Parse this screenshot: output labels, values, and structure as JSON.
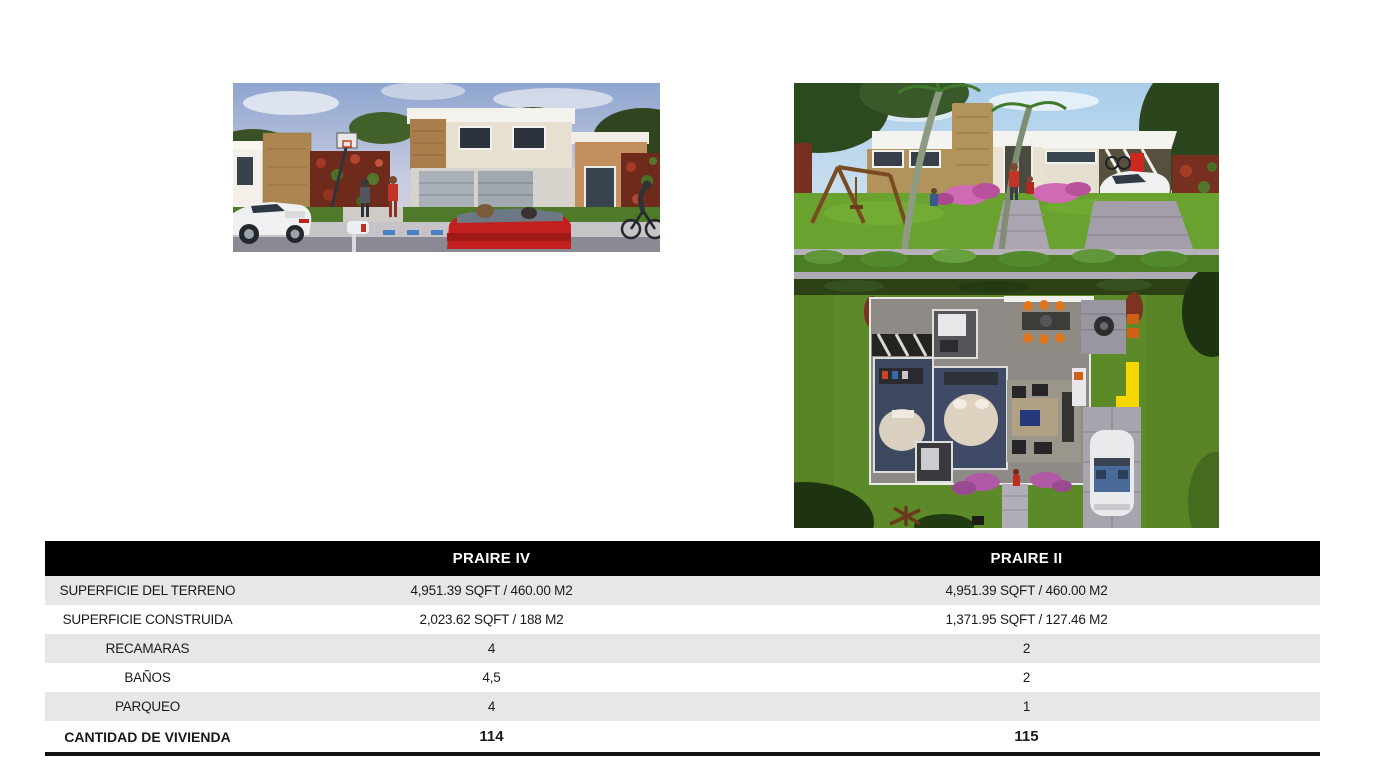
{
  "images": {
    "left_label": "PRAIRE IV street view render",
    "right_top_label": "PRAIRE II street view render",
    "right_bottom_label": "PRAIRE II aerial floor-plan render"
  },
  "table": {
    "header": {
      "col1": "PRAIRE IV",
      "col2": "PRAIRE II"
    },
    "rows": [
      {
        "label": "SUPERFICIE DEL TERRENO",
        "col1": "4,951.39 SQFT / 460.00 M2",
        "col2": "4,951.39 SQFT / 460.00 M2"
      },
      {
        "label": "SUPERFICIE CONSTRUIDA",
        "col1": "2,023.62 SQFT / 188 M2",
        "col2": "1,371.95 SQFT / 127.46 M2"
      },
      {
        "label": "RECAMARAS",
        "col1": "4",
        "col2": "2"
      },
      {
        "label": "BAÑOS",
        "col1": "4,5",
        "col2": "2"
      },
      {
        "label": "PARQUEO",
        "col1": "4",
        "col2": "1"
      }
    ],
    "total_row": {
      "label": "CANTIDAD DE VIVIENDA",
      "col1": "114",
      "col2": "115"
    },
    "colors": {
      "header_bg": "#000000",
      "header_text": "#ffffff",
      "stripe_bg": "#e7e7e7",
      "row_bg": "#ffffff",
      "bottom_rule": "#111111"
    }
  }
}
